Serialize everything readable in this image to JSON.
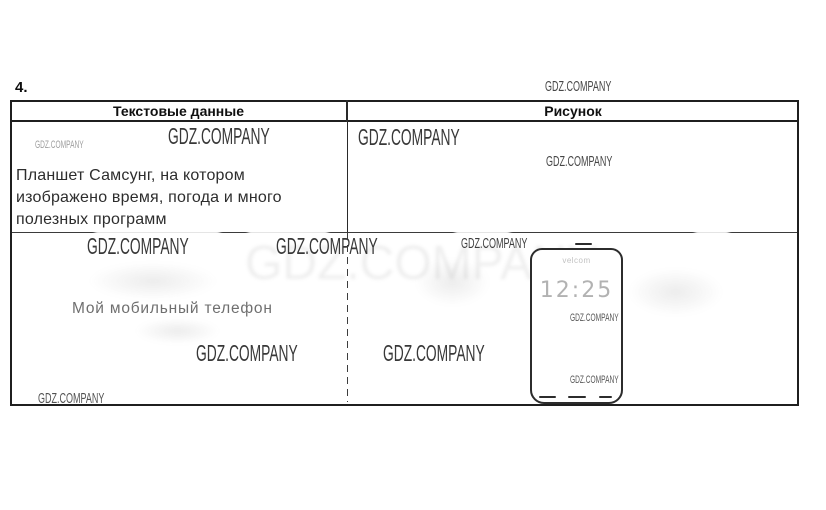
{
  "item_number": "4.",
  "watermark_text": "GDZ.COMPANY",
  "table": {
    "header_left": "Текстовые данные",
    "header_right": "Рисунок",
    "row1_lines": [
      "Планшет Самсунг, на котором",
      "изображено время, погода и много",
      "полезных программ"
    ],
    "row2_text": "Мой мобильный телефон"
  },
  "phone": {
    "status_text": "velcom",
    "time": "12:25"
  },
  "colors": {
    "table_border": "#1f1f1f",
    "watermark_dark": "#3a3a3a",
    "watermark_light": "#9e9e9e",
    "body_text": "#2d2d2d",
    "faded_text": "#636363",
    "time_text": "#a0a0a0"
  }
}
